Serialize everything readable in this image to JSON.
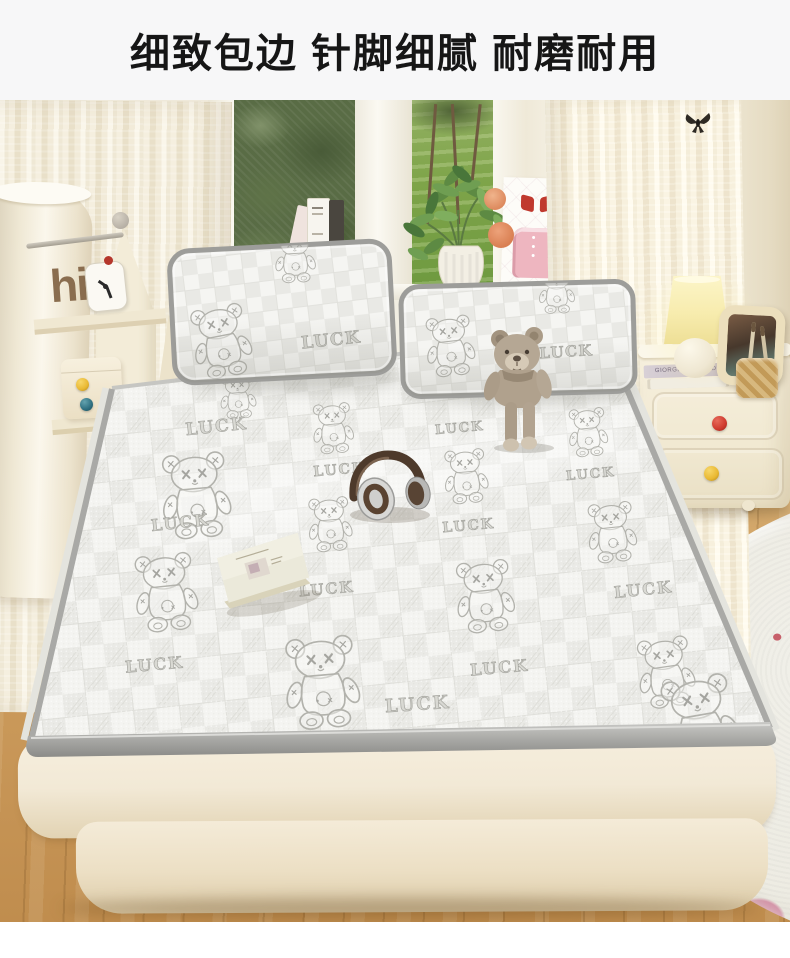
{
  "header": {
    "title": "细致包边 针脚细腻 耐磨耐用"
  },
  "scene": {
    "pattern_brand": "LUCK",
    "shelf_word": "hi",
    "card_letter": "D",
    "card_word": "Ribbon",
    "book_spine": "GIORGIO MORANDI",
    "colors": {
      "header_bg": "#f7f7f8",
      "title": "#161616",
      "wall": "#efe9da",
      "curtain_a": "#faf6ea",
      "curtain_b": "#e9e0c9",
      "grass": "#7ea449",
      "foliage": "#596c45",
      "floor_light": "#dbb57b",
      "floor_dark": "#c08d4e",
      "rug": "#ebe9df",
      "rug_pink": "#d898ab",
      "mat_base": "#f4f4f1",
      "mat_alt": "#eaeae6",
      "motif": "#b2b2ac",
      "piping": "#a9a9a6",
      "mattress": "#f2e9d6",
      "knob_red": "#cf3a2e",
      "knob_yellow": "#e9b832",
      "knob_teal": "#2e6f80",
      "lamp_glow": "#f7ecae",
      "teddy": "#b5a794",
      "headphone_brown": "#4e3a2b",
      "hi_brown": "#8a6d4f",
      "card_pink": "#eeb6c0",
      "bow_red": "#c0392e"
    },
    "mat_motifs": {
      "bears": [
        {
          "x": 196,
          "y": 395,
          "h": 88,
          "r": -5
        },
        {
          "x": 166,
          "y": 492,
          "h": 80,
          "r": -6
        },
        {
          "x": 238,
          "y": 296,
          "h": 46,
          "r": -4
        },
        {
          "x": 333,
          "y": 328,
          "h": 52,
          "r": -5
        },
        {
          "x": 330,
          "y": 424,
          "h": 56,
          "r": -5
        },
        {
          "x": 466,
          "y": 376,
          "h": 56,
          "r": -5
        },
        {
          "x": 588,
          "y": 332,
          "h": 50,
          "r": -5
        },
        {
          "x": 612,
          "y": 432,
          "h": 62,
          "r": -6
        },
        {
          "x": 485,
          "y": 496,
          "h": 74,
          "r": -6
        },
        {
          "x": 322,
          "y": 582,
          "h": 95,
          "r": -5
        },
        {
          "x": 666,
          "y": 572,
          "h": 72,
          "r": -8
        },
        {
          "x": 700,
          "y": 622,
          "h": 95,
          "r": -10
        }
      ],
      "lucks": [
        {
          "x": 217,
          "y": 332,
          "s": 17,
          "r": -6
        },
        {
          "x": 181,
          "y": 428,
          "s": 16,
          "r": -6
        },
        {
          "x": 340,
          "y": 374,
          "s": 14,
          "r": -5
        },
        {
          "x": 327,
          "y": 494,
          "s": 15,
          "r": -5
        },
        {
          "x": 155,
          "y": 570,
          "s": 16,
          "r": -5
        },
        {
          "x": 460,
          "y": 332,
          "s": 13,
          "r": -5
        },
        {
          "x": 591,
          "y": 378,
          "s": 13,
          "r": -5
        },
        {
          "x": 469,
          "y": 430,
          "s": 14,
          "r": -5
        },
        {
          "x": 644,
          "y": 495,
          "s": 16,
          "r": -6
        },
        {
          "x": 500,
          "y": 573,
          "s": 16,
          "r": -5
        },
        {
          "x": 418,
          "y": 610,
          "s": 18,
          "r": -4
        }
      ]
    }
  }
}
